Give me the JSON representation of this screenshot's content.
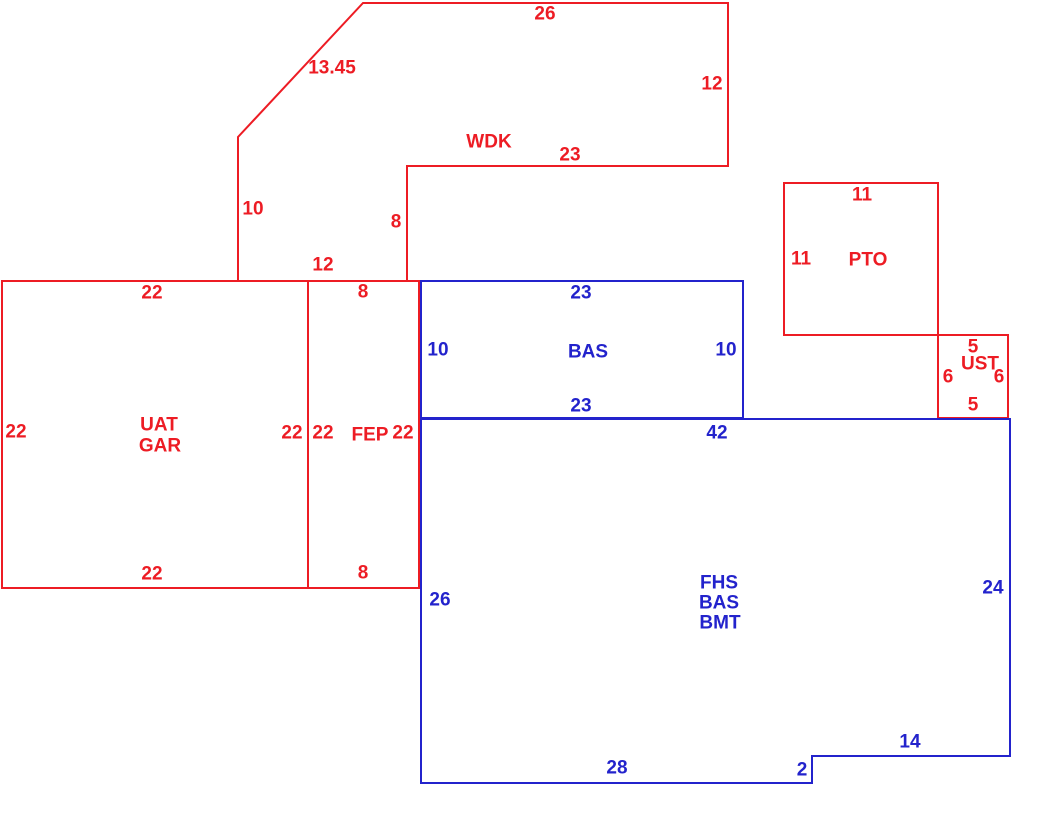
{
  "colors": {
    "red": "#ED1C24",
    "blue": "#2323CC",
    "background": "#FFFFFF"
  },
  "canvas": {
    "width": 1040,
    "height": 821
  },
  "sketch": {
    "shapes": [
      {
        "id": "wdk-outline",
        "area": "WDK",
        "color": "red",
        "points": [
          [
            363,
            3
          ],
          [
            728,
            3
          ],
          [
            728,
            166
          ],
          [
            407,
            166
          ],
          [
            407,
            281
          ],
          [
            238,
            281
          ],
          [
            238,
            137
          ]
        ]
      },
      {
        "id": "uat-gar-outline",
        "area": "UAT GAR",
        "color": "red",
        "points": [
          [
            2,
            281
          ],
          [
            308,
            281
          ],
          [
            308,
            588
          ],
          [
            2,
            588
          ]
        ]
      },
      {
        "id": "fep-outline",
        "area": "FEP",
        "color": "red",
        "points": [
          [
            308,
            281
          ],
          [
            419,
            281
          ],
          [
            419,
            588
          ],
          [
            308,
            588
          ]
        ]
      },
      {
        "id": "pto-outline",
        "area": "PTO",
        "color": "red",
        "points": [
          [
            784,
            183
          ],
          [
            938,
            183
          ],
          [
            938,
            335
          ],
          [
            784,
            335
          ]
        ]
      },
      {
        "id": "ust-outline",
        "area": "UST",
        "color": "red",
        "points": [
          [
            938,
            335
          ],
          [
            1008,
            335
          ],
          [
            1008,
            418
          ],
          [
            938,
            418
          ]
        ]
      },
      {
        "id": "bas-outline",
        "area": "BAS",
        "color": "blue",
        "points": [
          [
            421,
            281
          ],
          [
            743,
            281
          ],
          [
            743,
            418
          ],
          [
            421,
            418
          ]
        ]
      },
      {
        "id": "fhs-outline",
        "area": "FHS BAS BMT",
        "color": "blue",
        "points": [
          [
            421,
            419
          ],
          [
            1010,
            419
          ],
          [
            1010,
            756
          ],
          [
            812,
            756
          ],
          [
            812,
            783
          ],
          [
            421,
            783
          ]
        ]
      }
    ],
    "labels": [
      {
        "name": "wdk-dim-top",
        "text": "26",
        "x": 545,
        "y": 14,
        "color": "red"
      },
      {
        "name": "wdk-dim-diagonal",
        "text": "13.45",
        "x": 332,
        "y": 68,
        "color": "red"
      },
      {
        "name": "wdk-dim-right",
        "text": "12",
        "x": 712,
        "y": 84,
        "color": "red"
      },
      {
        "name": "wdk-area-label",
        "text": "WDK",
        "x": 489,
        "y": 142,
        "color": "red"
      },
      {
        "name": "wdk-dim-bottom",
        "text": "23",
        "x": 570,
        "y": 155,
        "color": "red"
      },
      {
        "name": "wdk-dim-left",
        "text": "10",
        "x": 253,
        "y": 209,
        "color": "red"
      },
      {
        "name": "wdk-dim-inner-right",
        "text": "8",
        "x": 396,
        "y": 222,
        "color": "red"
      },
      {
        "name": "wdk-dim-bottom-left",
        "text": "12",
        "x": 323,
        "y": 265,
        "color": "red"
      },
      {
        "name": "pto-dim-top",
        "text": "11",
        "x": 862,
        "y": 195,
        "color": "red"
      },
      {
        "name": "pto-dim-left",
        "text": "11",
        "x": 801,
        "y": 259,
        "color": "red"
      },
      {
        "name": "pto-area-label",
        "text": "PTO",
        "x": 868,
        "y": 260,
        "color": "red"
      },
      {
        "name": "ust-dim-top",
        "text": "5",
        "x": 973,
        "y": 347,
        "color": "red"
      },
      {
        "name": "ust-area-label",
        "text": "UST",
        "x": 980,
        "y": 364,
        "color": "red"
      },
      {
        "name": "ust-dim-left",
        "text": "6",
        "x": 948,
        "y": 377,
        "color": "red"
      },
      {
        "name": "ust-dim-right",
        "text": "6",
        "x": 999,
        "y": 377,
        "color": "red"
      },
      {
        "name": "ust-dim-bottom",
        "text": "5",
        "x": 973,
        "y": 405,
        "color": "red"
      },
      {
        "name": "uatgar-dim-top",
        "text": "22",
        "x": 152,
        "y": 293,
        "color": "red"
      },
      {
        "name": "uatgar-dim-left",
        "text": "22",
        "x": 16,
        "y": 432,
        "color": "red"
      },
      {
        "name": "uatgar-area-line1",
        "text": "UAT",
        "x": 159,
        "y": 425,
        "color": "red"
      },
      {
        "name": "uatgar-area-line2",
        "text": "GAR",
        "x": 160,
        "y": 446,
        "color": "red"
      },
      {
        "name": "uatgar-dim-right",
        "text": "22",
        "x": 292,
        "y": 433,
        "color": "red"
      },
      {
        "name": "uatgar-dim-bottom",
        "text": "22",
        "x": 152,
        "y": 574,
        "color": "red"
      },
      {
        "name": "fep-dim-top",
        "text": "8",
        "x": 363,
        "y": 292,
        "color": "red"
      },
      {
        "name": "fep-dim-left",
        "text": "22",
        "x": 323,
        "y": 433,
        "color": "red"
      },
      {
        "name": "fep-area-label",
        "text": "FEP",
        "x": 370,
        "y": 435,
        "color": "red"
      },
      {
        "name": "fep-dim-right",
        "text": "22",
        "x": 403,
        "y": 433,
        "color": "red"
      },
      {
        "name": "fep-dim-bottom",
        "text": "8",
        "x": 363,
        "y": 573,
        "color": "red"
      },
      {
        "name": "bas-dim-top",
        "text": "23",
        "x": 581,
        "y": 293,
        "color": "blue"
      },
      {
        "name": "bas-dim-left",
        "text": "10",
        "x": 438,
        "y": 350,
        "color": "blue"
      },
      {
        "name": "bas-area-label",
        "text": "BAS",
        "x": 588,
        "y": 352,
        "color": "blue"
      },
      {
        "name": "bas-dim-right",
        "text": "10",
        "x": 726,
        "y": 350,
        "color": "blue"
      },
      {
        "name": "bas-dim-bottom",
        "text": "23",
        "x": 581,
        "y": 406,
        "color": "blue"
      },
      {
        "name": "fhs-dim-top",
        "text": "42",
        "x": 717,
        "y": 433,
        "color": "blue"
      },
      {
        "name": "fhs-dim-left",
        "text": "26",
        "x": 440,
        "y": 600,
        "color": "blue"
      },
      {
        "name": "fhs-area-line1",
        "text": "FHS",
        "x": 719,
        "y": 583,
        "color": "blue"
      },
      {
        "name": "fhs-area-line2",
        "text": "BAS",
        "x": 719,
        "y": 603,
        "color": "blue"
      },
      {
        "name": "fhs-area-line3",
        "text": "BMT",
        "x": 720,
        "y": 623,
        "color": "blue"
      },
      {
        "name": "fhs-dim-right",
        "text": "24",
        "x": 993,
        "y": 588,
        "color": "blue"
      },
      {
        "name": "fhs-dim-step-bottom",
        "text": "14",
        "x": 910,
        "y": 742,
        "color": "blue"
      },
      {
        "name": "fhs-dim-step-side",
        "text": "2",
        "x": 802,
        "y": 770,
        "color": "blue"
      },
      {
        "name": "fhs-dim-bottom",
        "text": "28",
        "x": 617,
        "y": 768,
        "color": "blue"
      }
    ]
  }
}
